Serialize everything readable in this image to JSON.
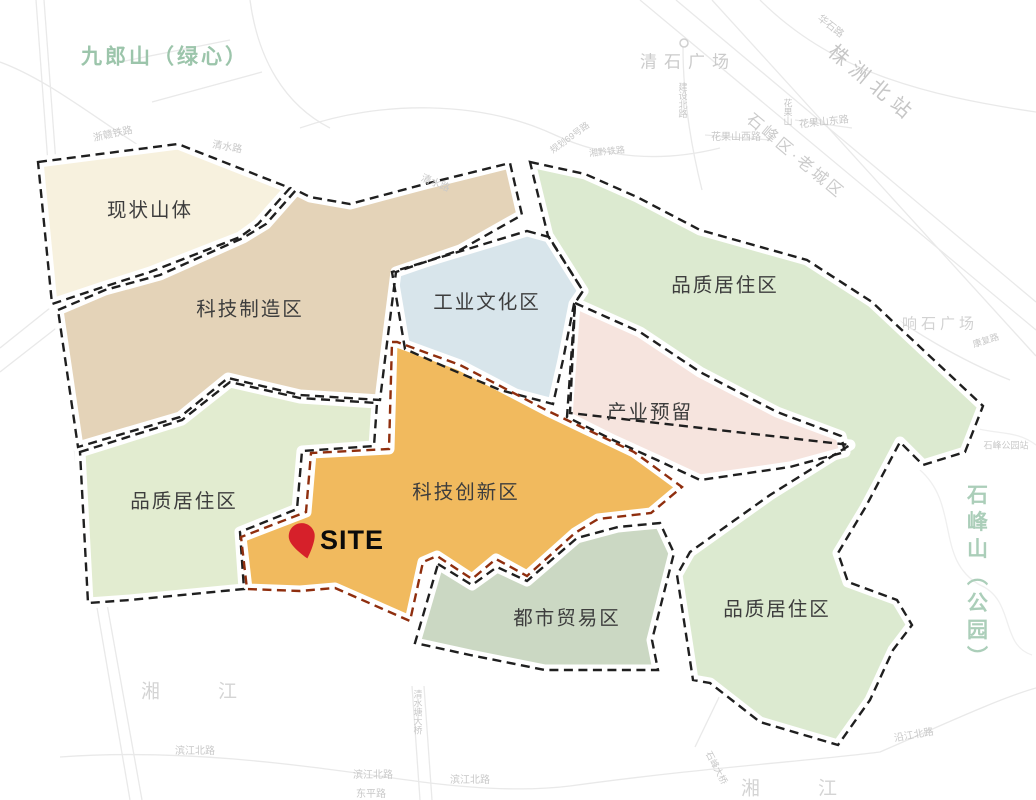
{
  "colors": {
    "background": "#ffffff",
    "zone_dash": "#1f1f1f",
    "innovation_dash": "#8f2e0e",
    "casing": "#ffffff",
    "basemap_line": "#e9e9e9",
    "zone_label_text": "#3d3d3d",
    "green_area_label": "#9cc5ab",
    "gray_area_label": "#c9c9c9",
    "site_pin": "#d6202a"
  },
  "site": {
    "label": "SITE"
  },
  "zones": [
    {
      "name": "zone-residential-ne",
      "label": "品质居住区",
      "fill": "#dcead0",
      "border": "#1f1f1f",
      "label_x": 725,
      "label_y": 286,
      "path": "M530,162 L585,174 L637,197 L700,230 L807,260 L872,302 L983,406 L965,452 L923,465 L900,442 L865,508 L838,553 L848,582 L897,600 L912,625 L893,650 L870,700 L838,745 L760,722 L710,683 L693,680 L677,575 L690,552 L770,495 L850,445 L570,413 L575,303 L583,291 L548,236 Z"
    },
    {
      "name": "zone-industry-reserve",
      "label": "产业预留",
      "fill": "#f6e4de",
      "border": "#1f1f1f",
      "label_x": 650,
      "label_y": 413,
      "path": "M575,303 L640,332 L700,372 L777,412 L841,436 L845,452 L790,467 L700,480 L657,460 L613,440 L567,417 Z"
    },
    {
      "name": "zone-industrial-culture",
      "label": "工业文化区",
      "fill": "#d8e5eb",
      "border": "#1f1f1f",
      "label_x": 487,
      "label_y": 303,
      "path": "M527,231 L549,237 L583,291 L574,304 L563,360 L553,404 L500,390 L450,369 L405,349 L392,272 Z"
    },
    {
      "name": "zone-tech-manufacturing",
      "label": "科技制造区",
      "fill": "#e4d3b8",
      "border": "#1f1f1f",
      "label_x": 250,
      "label_y": 310,
      "path": "M58,310 L105,290 L160,275 L243,238 L266,224 L296,190 L310,197 L350,204 L425,184 L510,163 L522,215 L460,250 L396,272 L388,335 L380,400 L300,395 L228,378 L180,417 L78,447 Z"
    },
    {
      "name": "zone-existing-mountain",
      "label": "现状山体",
      "fill": "#f7f1de",
      "border": "#1f1f1f",
      "label_x": 150,
      "label_y": 211,
      "path": "M38,162 L178,144 L290,188 L258,224 L240,237 L150,272 L100,288 L52,304 Z"
    },
    {
      "name": "zone-residential-w",
      "label": "品质居住区",
      "fill": "#e2ecd0",
      "border": "#1f1f1f",
      "label_x": 184,
      "label_y": 502,
      "path": "M80,452 L182,420 L230,382 L300,398 L377,403 L374,446 L302,451 L297,509 L240,532 L244,589 L130,600 L88,603 Z"
    },
    {
      "name": "zone-tech-innovation",
      "label": "科技创新区",
      "fill": "#f1ba5e",
      "border": "#8f2e0e",
      "label_x": 466,
      "label_y": 493,
      "path": "M392,342 L397,342 L460,365 L548,411 L634,452 L682,487 L651,513 L598,519 L575,533 L527,576 L496,559 L472,579 L437,556 L423,562 L410,621 L335,588 L300,591 L247,589 L241,537 L306,512 L311,453 L389,449 Z"
    },
    {
      "name": "zone-urban-trade",
      "label": "都市贸易区",
      "fill": "#cbd8c3",
      "border": "#1f1f1f",
      "label_x": 567,
      "label_y": 619,
      "path": "M438,564 L472,585 L497,567 L527,581 L577,538 L618,527 L660,523 L674,553 L652,640 L658,670 L545,670 L470,655 L415,643 Z"
    },
    {
      "name": "zone-residential-se-label",
      "label": "品质居住区",
      "fill": "#dcead0",
      "border": "#1f1f1f",
      "label_x": 777,
      "label_y": 610,
      "path": null
    }
  ],
  "map_labels": [
    {
      "name": "area-label-jiulangshan",
      "text": "九郎山（绿心）",
      "x": 165,
      "y": 57,
      "size": 21,
      "color": "#9cc5ab",
      "ls": 3,
      "bold": true
    },
    {
      "name": "area-label-qingshi-square",
      "text": "清石广场",
      "x": 688,
      "y": 62,
      "size": 17,
      "color": "#cbcbcb",
      "ls": 7
    },
    {
      "name": "area-label-zhuzhou-north-station",
      "text": "株洲北站",
      "x": 872,
      "y": 84,
      "size": 20,
      "color": "#c6c6c6",
      "ls": 7,
      "rot": 40
    },
    {
      "name": "area-label-shifeng-old-town",
      "text": "石峰区·老城区",
      "x": 795,
      "y": 157,
      "size": 16,
      "color": "#cbcbcb",
      "ls": 3,
      "rot": 40
    },
    {
      "name": "area-label-xiangshi-square",
      "text": "响石广场",
      "x": 940,
      "y": 324,
      "size": 15,
      "color": "#d2d2d2",
      "ls": 4
    },
    {
      "name": "area-label-shifengshan-park",
      "text": "石峰山（公园）",
      "x": 976,
      "y": 578,
      "size": 21,
      "color": "#abceb9",
      "ls": 6,
      "bold": true,
      "vertical": true
    },
    {
      "name": "area-label-xiangjiang-west",
      "text": "湘江",
      "x": 218,
      "y": 692,
      "size": 19,
      "color": "#d4d4d4",
      "ls": 58
    },
    {
      "name": "area-label-xiangjiang-south",
      "text": "湘江",
      "x": 818,
      "y": 789,
      "size": 19,
      "color": "#d4d4d4",
      "ls": 58
    },
    {
      "name": "road-label-huashi-rd",
      "text": "华石路",
      "x": 830,
      "y": 27,
      "size": 10,
      "color": "#c8c8c8",
      "rot": 38
    },
    {
      "name": "road-label-zhegan-railway",
      "text": "浙赣铁路",
      "x": 113,
      "y": 135,
      "size": 10,
      "color": "#c8c8c8",
      "rot": -12
    },
    {
      "name": "road-label-qingshui-rd-1",
      "text": "清水路",
      "x": 227,
      "y": 148,
      "size": 10,
      "color": "#c8c8c8",
      "rot": 10
    },
    {
      "name": "road-label-qingshui-rd-2",
      "text": "清水路",
      "x": 435,
      "y": 184,
      "size": 10,
      "color": "#c8c8c8",
      "rot": 22
    },
    {
      "name": "road-label-planned-rd-69",
      "text": "规划69号路",
      "x": 570,
      "y": 138,
      "size": 9,
      "color": "#c8c8c8",
      "rot": -36
    },
    {
      "name": "road-label-xiangqian-railway",
      "text": "湘黔铁路",
      "x": 607,
      "y": 152,
      "size": 9,
      "color": "#c8c8c8",
      "rot": -6
    },
    {
      "name": "road-label-jianshe-north-rd",
      "text": "建设北路",
      "x": 682,
      "y": 100,
      "size": 9,
      "color": "#c8c8c8",
      "vertical": true
    },
    {
      "name": "road-label-huaguoshan",
      "text": "花果山",
      "x": 787,
      "y": 112,
      "size": 9,
      "color": "#c8c8c8",
      "vertical": true
    },
    {
      "name": "road-label-huaguoshan-west-rd",
      "text": "花果山西路",
      "x": 736,
      "y": 138,
      "size": 10,
      "color": "#c8c8c8"
    },
    {
      "name": "road-label-huaguoshan-east-rd",
      "text": "花果山东路",
      "x": 824,
      "y": 123,
      "size": 10,
      "color": "#c8c8c8",
      "rot": -6
    },
    {
      "name": "road-label-kangfu-rd",
      "text": "康复路",
      "x": 986,
      "y": 341,
      "size": 9,
      "color": "#c8c8c8",
      "rot": -18
    },
    {
      "name": "road-label-shifeng-park-station",
      "text": "石峰公园站",
      "x": 1006,
      "y": 446,
      "size": 9,
      "color": "#c8c8c8"
    },
    {
      "name": "road-label-binjiang-north-rd-1",
      "text": "滨江北路",
      "x": 195,
      "y": 752,
      "size": 10,
      "color": "#c8c8c8"
    },
    {
      "name": "road-label-binjiang-north-rd-2",
      "text": "滨江北路",
      "x": 373,
      "y": 776,
      "size": 10,
      "color": "#c8c8c8"
    },
    {
      "name": "road-label-binjiang-north-rd-3",
      "text": "滨江北路",
      "x": 470,
      "y": 781,
      "size": 10,
      "color": "#c8c8c8"
    },
    {
      "name": "road-label-yanjiang-north-rd",
      "text": "沿江北路",
      "x": 914,
      "y": 736,
      "size": 10,
      "color": "#c8c8c8",
      "rot": -10
    },
    {
      "name": "road-label-qingshuitang-bridge",
      "text": "清水塘大桥",
      "x": 417,
      "y": 712,
      "size": 9,
      "color": "#c8c8c8",
      "vertical": true
    },
    {
      "name": "road-label-shifeng-bridge",
      "text": "石峰大桥",
      "x": 716,
      "y": 768,
      "size": 9,
      "color": "#c8c8c8",
      "rot": 62
    },
    {
      "name": "road-label-dongping-rd",
      "text": "东平路",
      "x": 371,
      "y": 795,
      "size": 10,
      "color": "#c8c8c8"
    }
  ]
}
